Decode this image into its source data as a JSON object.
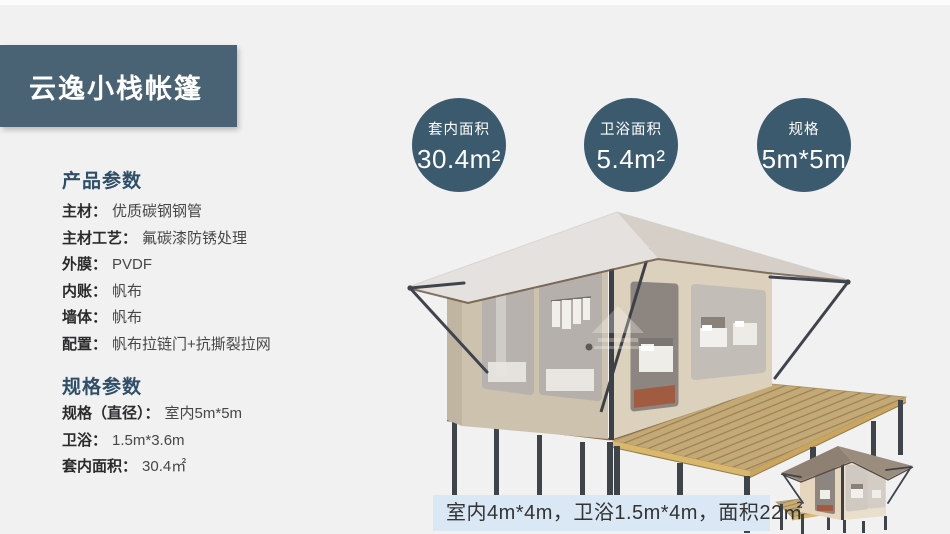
{
  "header": {
    "title": "云逸小栈帐篷"
  },
  "stats": [
    {
      "label": "套内面积",
      "value": "30.4m²"
    },
    {
      "label": "卫浴面积",
      "value": "5.4m²"
    },
    {
      "label": "规格",
      "value": "5m*5m"
    }
  ],
  "product_params": {
    "heading": "产品参数",
    "rows": [
      {
        "label": "主材：",
        "value": "优质碳钢钢管"
      },
      {
        "label": "主材工艺：",
        "value": "氟碳漆防锈处理"
      },
      {
        "label": "外膜：",
        "value": "PVDF"
      },
      {
        "label": "内账：",
        "value": "帆布"
      },
      {
        "label": "墙体：",
        "value": "帆布"
      },
      {
        "label": "配置：",
        "value": "帆布拉链门+抗撕裂拉网"
      }
    ]
  },
  "spec_params": {
    "heading": "规格参数",
    "rows": [
      {
        "label": "规格（直径）：",
        "value": "室内5m*5m"
      },
      {
        "label": "卫浴：",
        "value": "1.5m*3.6m"
      },
      {
        "label": "套内面积：",
        "value": "30.4㎡"
      }
    ]
  },
  "footer_note": {
    "text": "室内4m*4m，卫浴1.5m*4m，面积22㎡"
  },
  "colors": {
    "page_bg": "#f1f1f2",
    "banner_bg": "#4a6374",
    "circle_bg": "#3b5a6e",
    "heading_text": "#2f4f68",
    "footer_strip_bg": "#d9e8f4",
    "tent_wall": "#cdc2ae",
    "tent_roof": "#e4e1de",
    "deck_wood": "#c5a975"
  }
}
